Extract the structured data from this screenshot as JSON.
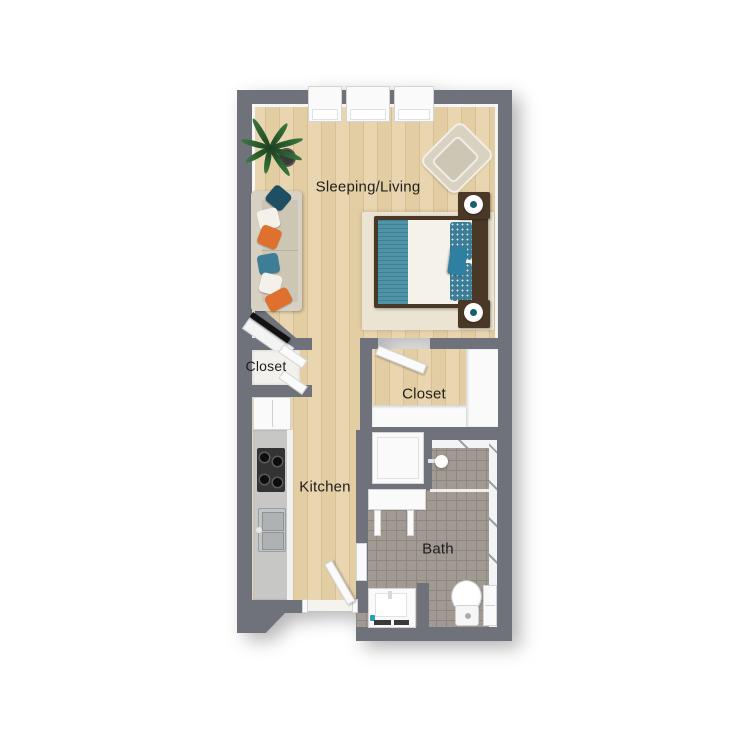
{
  "floorplan": {
    "type": "studio-apartment-floor-plan-3d-top-view",
    "rooms": [
      {
        "id": "sleeping-living",
        "label": "Sleeping/Living"
      },
      {
        "id": "closet-left",
        "label": "Closet"
      },
      {
        "id": "closet-middle",
        "label": "Closet"
      },
      {
        "id": "kitchen",
        "label": "Kitchen"
      },
      {
        "id": "bath",
        "label": "Bath"
      }
    ],
    "fixtures": [
      "windows-x3",
      "plant",
      "sofa",
      "tv",
      "armchair",
      "bed",
      "nightstand-x2",
      "lamp-x2",
      "rug",
      "bifold-closet-doors",
      "closet-door",
      "entry-door",
      "fridge",
      "stove",
      "kitchen-sink",
      "washer-dryer",
      "console-table",
      "shower-head",
      "bath-door",
      "vanity-sink",
      "toilet",
      "bath-cabinet"
    ]
  },
  "colors": {
    "wall": "#6f727a",
    "wood_a": "#e9d6b0",
    "wood_b": "#e3cda2",
    "wood_line": "#d6c094",
    "tile": "#a09a92",
    "tile_line": "#8d8780",
    "fixture": "#fafafa",
    "rug": "#ebe4d3",
    "counter": "#c7c7c5",
    "stove": "#333333",
    "teal": "#4f93a8",
    "teal_dark": "#1f4f63",
    "teal_pillow": "#3d7e96",
    "orange": "#e0702e",
    "dark_wood": "#4a3827",
    "sofa_body": "#d7d1c4",
    "sofa_seat": "#cdc6b5",
    "label": "#1e1e1e"
  }
}
